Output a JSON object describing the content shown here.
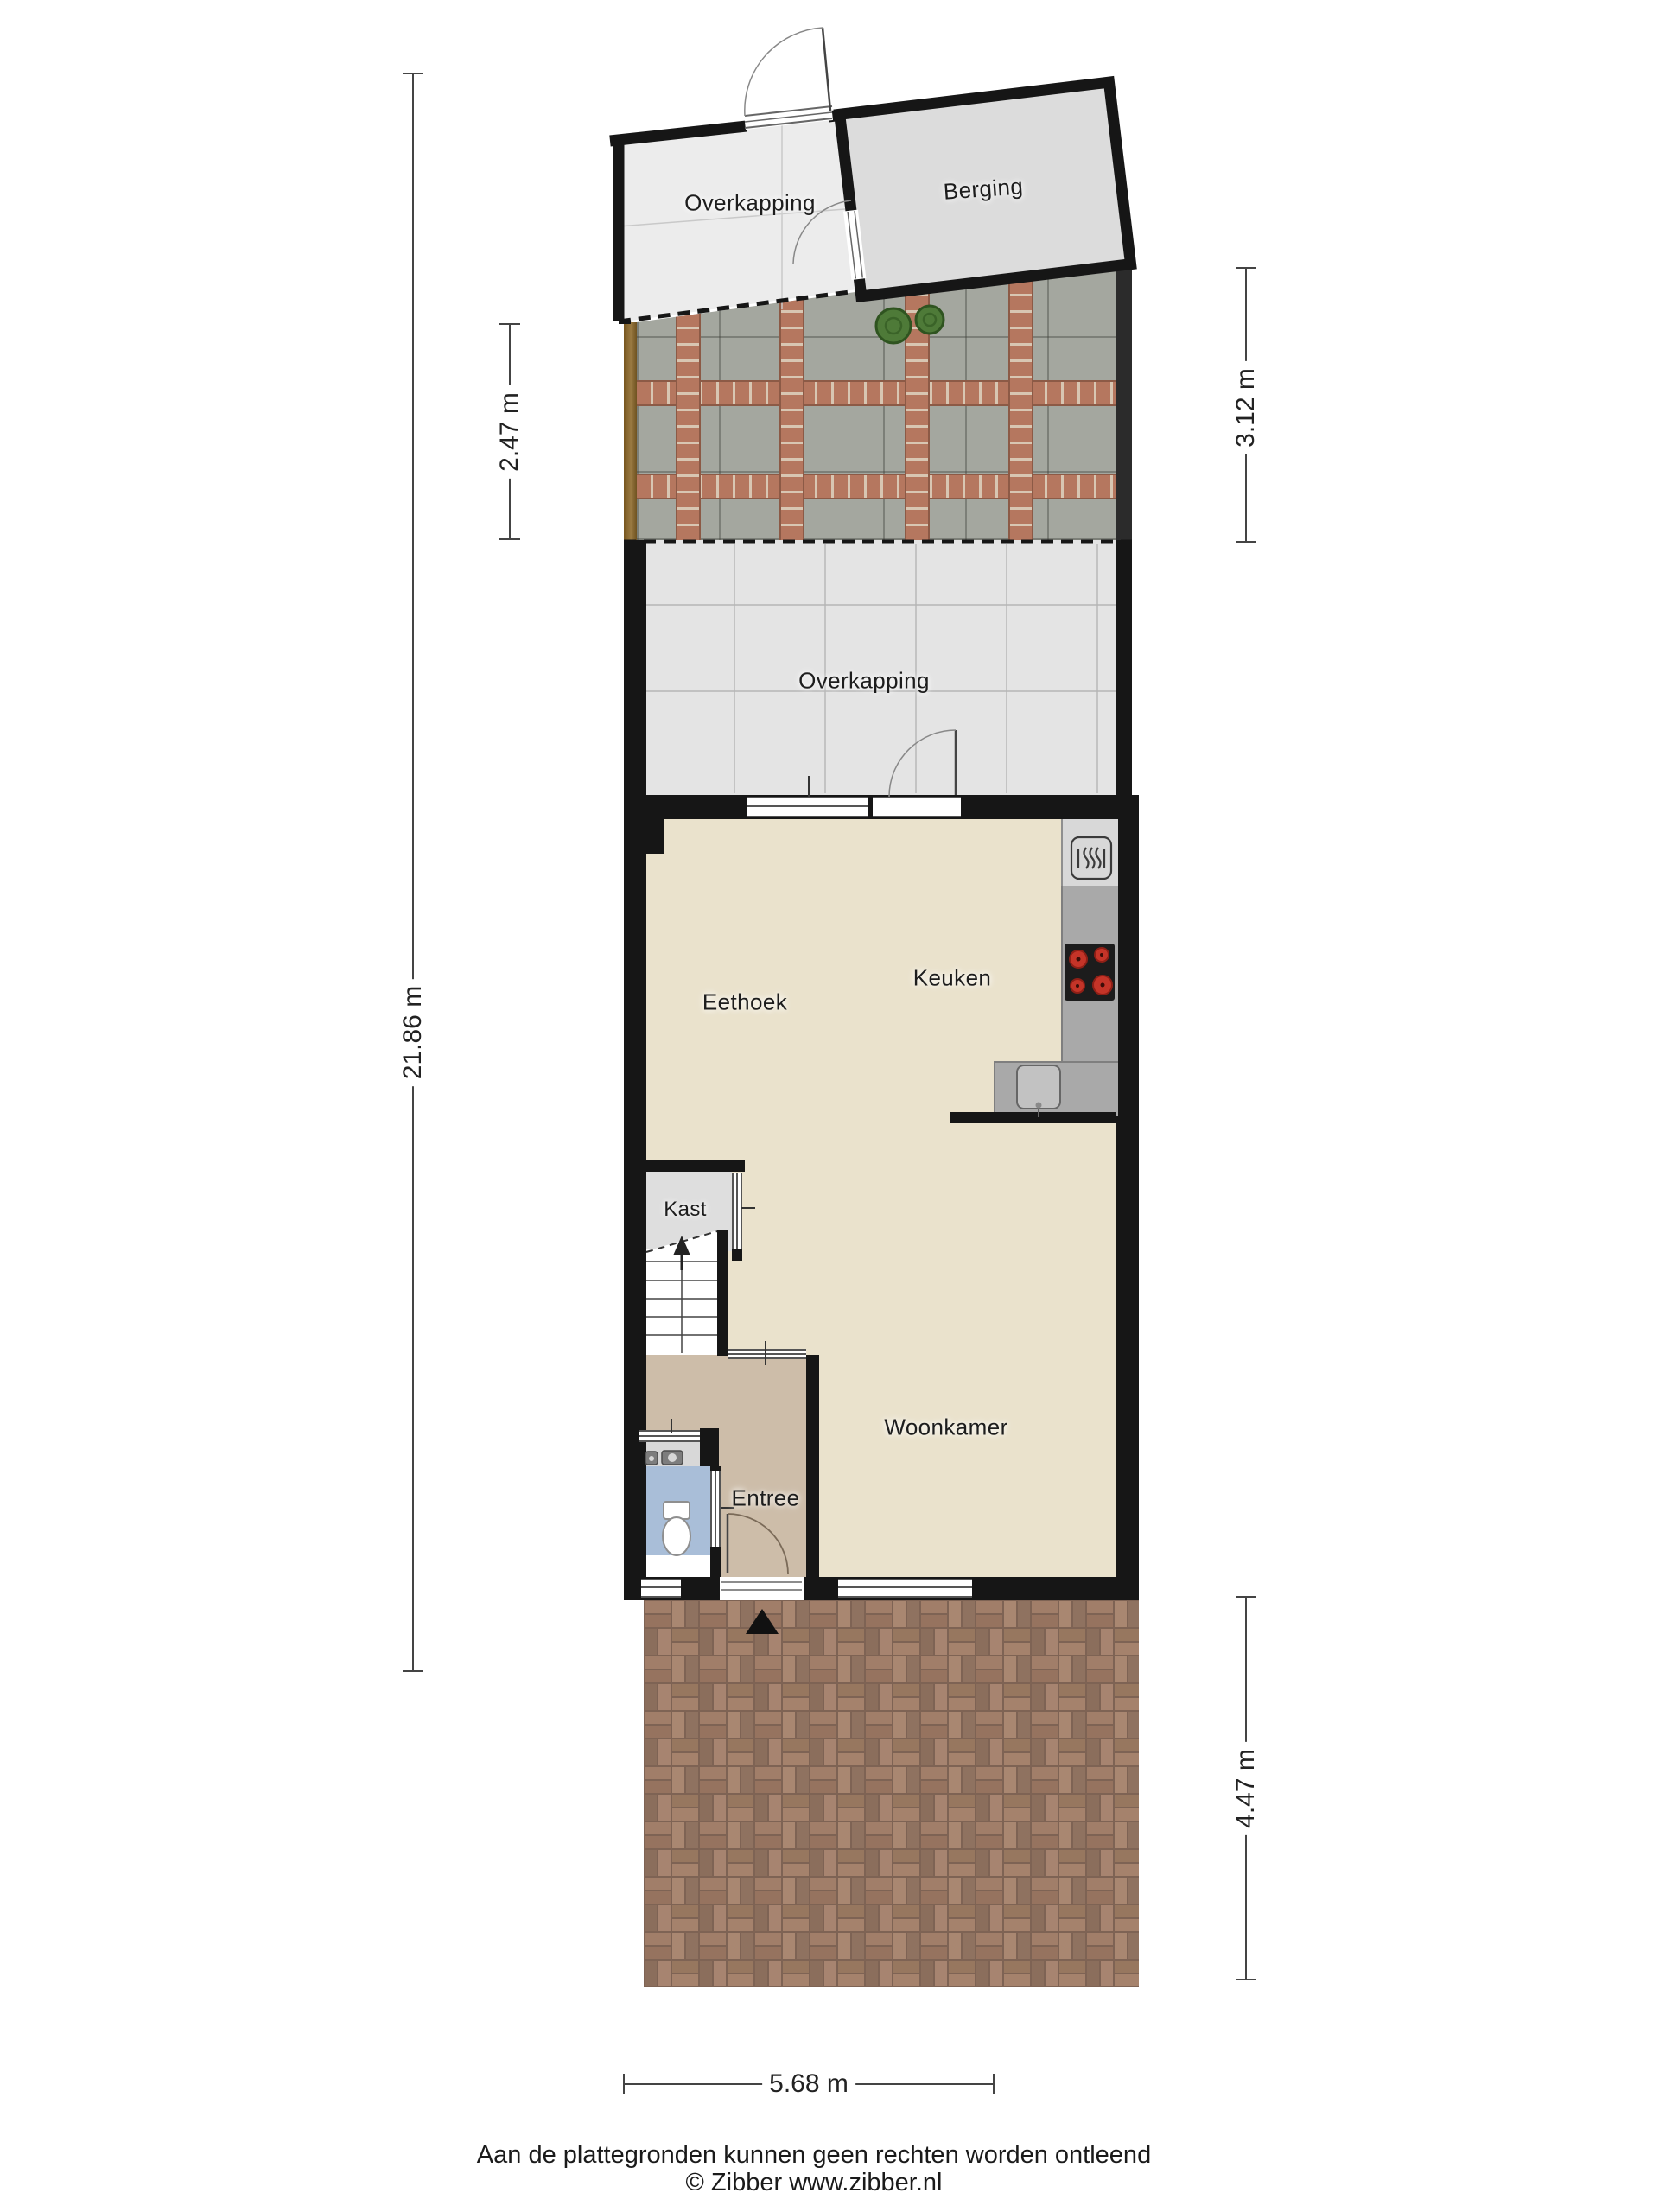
{
  "rooms": {
    "overkapping_top": "Overkapping",
    "berging": "Berging",
    "overkapping": "Overkapping",
    "eethoek": "Eethoek",
    "keuken": "Keuken",
    "kast": "Kast",
    "woonkamer": "Woonkamer",
    "entree": "Entree"
  },
  "dimensions": {
    "total_left": "21.86 m",
    "garden_left": "2.47 m",
    "garden_right": "3.12 m",
    "front_yard_right": "4.47 m",
    "bottom_width": "5.68 m"
  },
  "footer": {
    "disclaimer": "Aan de plattegronden kunnen geen rechten worden ontleend",
    "copyright": "© Zibber www.zibber.nl"
  },
  "icons": {
    "oven": "oven-icon",
    "cooktop": "cooktop-icon",
    "sink": "sink-icon",
    "toilet": "toilet-icon",
    "washbasin": "washbasin-icon",
    "stairs_arrow": "stairs-up-arrow-icon",
    "entrance_marker": "entrance-marker-icon",
    "plants": "plant-icon"
  },
  "colors": {
    "wall": "#161616",
    "floor_main": "#eae2cc",
    "floor_entree": "#cdbda9",
    "floor_toilet": "#a9bed8",
    "floor_kast": "#dedede",
    "overkapping_fill": "#e4e4e4",
    "counter_light": "#d8d8d8",
    "counter_dark": "#a9a9a9",
    "burner_red": "#c43428",
    "patio_tile": "#a4a79f",
    "patio_brick": "#b5775f",
    "yard_brick": "#9c7c69",
    "wood_edge": "#8a6a42"
  }
}
